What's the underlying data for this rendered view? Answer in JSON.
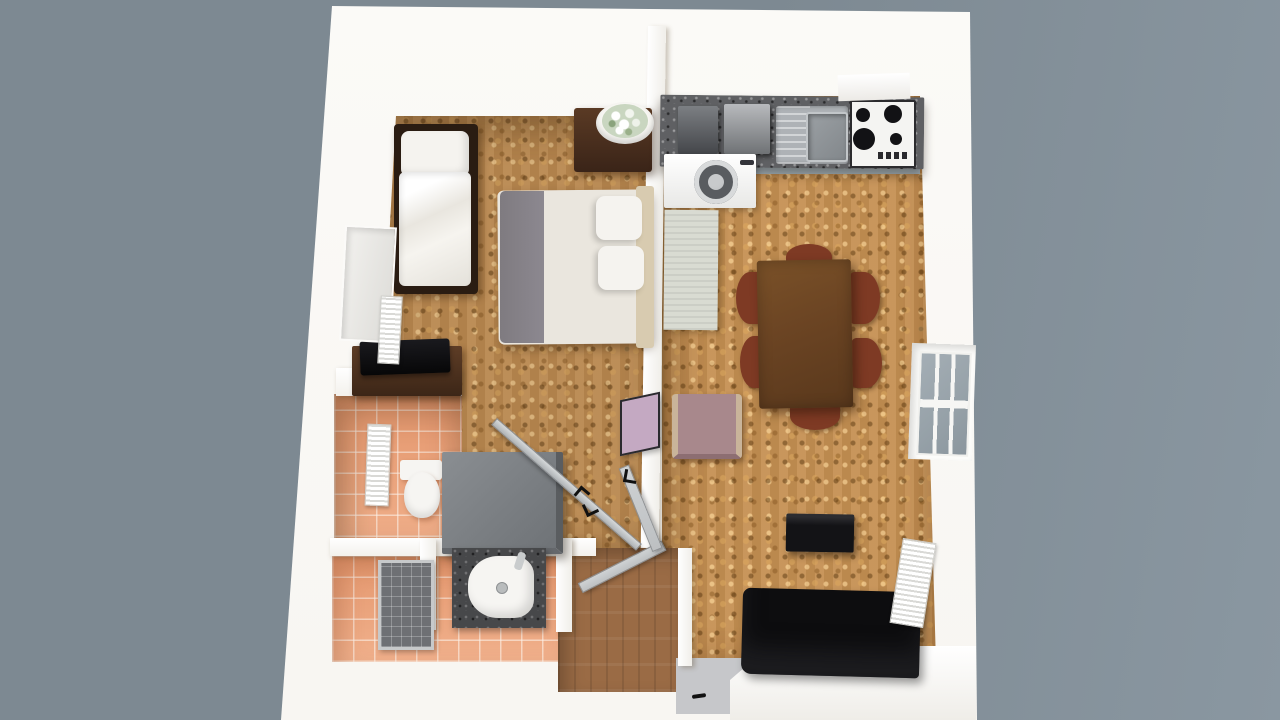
{
  "scene": {
    "title": "3D rendered one-bedroom apartment floor plan, top-down isometric view",
    "view": "top-down 3d render",
    "visible_text": "none"
  },
  "palette": {
    "background": "#7d8992",
    "background_right": "#8a97a1",
    "shell": "#f8f6f2",
    "wall": "#ffffff",
    "wall_shade": "#e9e6e0",
    "cork_floor": "#b9884f",
    "bathroom_tile": "#ec9f75",
    "hall_wood": "#9a6b45",
    "entry_floor": "#c6c7ca",
    "granite_counter": "#5f6063",
    "steel_sink": "#aeb2b6",
    "hob": "#f4f4f2",
    "burner": "#121215",
    "washing_machine": "#f2f2f0",
    "cabinet": "#d9dbd2",
    "dining_table": "#6b4423",
    "chair": "#7e3a24",
    "sofa": "#0d0d0f",
    "tv": "#131316",
    "armchair": "#a8888c",
    "mirror_panel": "#c4a9c2",
    "duvet": "#eae6de",
    "bed_runner": "#8c8890",
    "pillow": "#f5f3ef",
    "headboard": "#d8cbb0",
    "bed_frame": "#2a1c12",
    "nightstand": "#3a2418",
    "shower_box": "#7b7f83",
    "shower_box_dark": "#5a5d60",
    "sink_counter": "#3f4044",
    "porcelain": "#f6f5f2",
    "radiator": "#f1f1ef",
    "door": "#bdc0c2",
    "window_glass": "#96a1a8"
  },
  "rooms": [
    {
      "id": "bedroom",
      "label": "Bedroom",
      "floor": "cork",
      "items": [
        "single-bed",
        "double-bed",
        "nightstand",
        "flower-bowl",
        "desk",
        "laptop",
        "window",
        "radiator",
        "mirror-panel"
      ]
    },
    {
      "id": "kitchen-living",
      "label": "Kitchen / Living room",
      "floor": "cork",
      "items": [
        "kitchen-counter",
        "small-appliances",
        "steel-sink",
        "gas-hob",
        "washing-machine",
        "tall-cabinet",
        "dining-table",
        "six-chairs",
        "armchair",
        "tv",
        "sofa",
        "radiator",
        "window"
      ]
    },
    {
      "id": "bathroom",
      "label": "Bathroom",
      "floor": "terracotta-tile",
      "items": [
        "toilet",
        "radiator",
        "shower-enclosure",
        "wash-basin",
        "shower-tray"
      ]
    },
    {
      "id": "hallway",
      "label": "Hallway",
      "floor": "wood",
      "items": [
        "open-door",
        "open-door",
        "glass-door"
      ]
    },
    {
      "id": "entry",
      "label": "Entry",
      "floor": "gray",
      "items": [
        "threshold",
        "door-handle"
      ]
    }
  ]
}
